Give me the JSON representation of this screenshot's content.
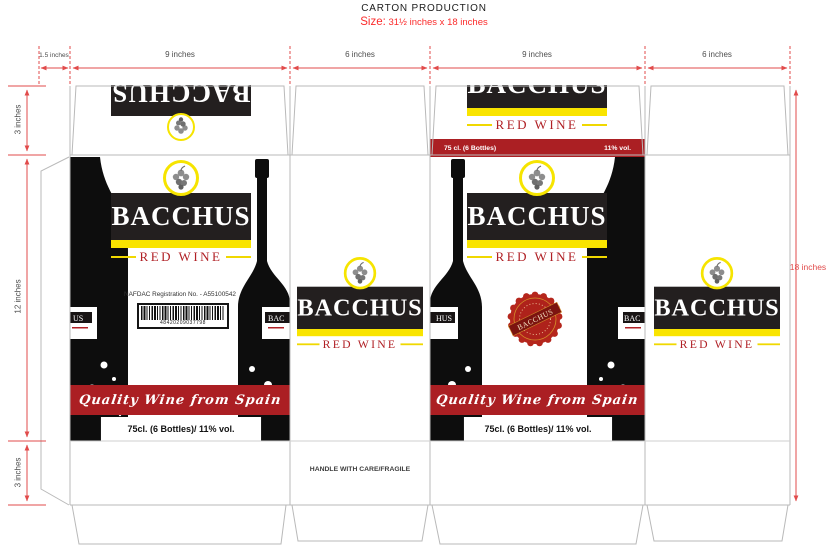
{
  "header": {
    "title": "CARTON PRODUCTION",
    "size_label": "Size:",
    "size_value": "31½  inches x 18 inches"
  },
  "dims": {
    "top": [
      {
        "label": "1.5 inches"
      },
      {
        "label": "9 inches"
      },
      {
        "label": "6 inches"
      },
      {
        "label": "9 inches"
      },
      {
        "label": "6 inches"
      }
    ],
    "left": [
      {
        "label": "3 inches"
      },
      {
        "label": "12 inches"
      },
      {
        "label": "3 inches"
      }
    ],
    "right": {
      "label": "18 inches"
    }
  },
  "brand": {
    "name": "BACCHUS",
    "subtitle": "RED WINE",
    "tagline": "Quality Wine from Spain"
  },
  "front_panel": {
    "nafdac": "NAFDAC Registration No. - A55100542",
    "barcode_number": "48420209037798",
    "volume": "75cl. (6 Bottles)/ 11% vol."
  },
  "back_panel": {
    "volume": "75cl. (6 Bottles)/ 11% vol."
  },
  "back_flap": {
    "volume_left": "75 cl. (6 Bottles)",
    "volume_right": "11% vol."
  },
  "side_panel": {
    "handling": "HANDLE WITH CARE/FRAGILE"
  },
  "seal": {
    "name": "BACCHUS"
  },
  "bottles": {
    "a_left": "US",
    "a_right": "BAC",
    "c_left": "HUS",
    "c_right": "BAC"
  },
  "colors": {
    "accent_red": "#ab1f23",
    "dim_red": "#e14b4b",
    "size_red": "#fb2b2b",
    "yellow": "#f9e400",
    "logo_black": "#231f1f"
  }
}
